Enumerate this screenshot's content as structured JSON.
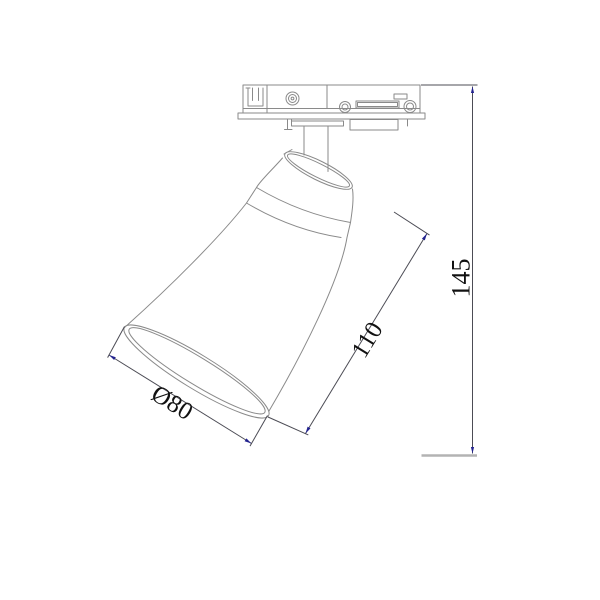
{
  "dimensions": {
    "diameter": {
      "label": "Ø80"
    },
    "length": {
      "label": "110"
    },
    "height": {
      "label": "145"
    }
  },
  "colors": {
    "background": "#ffffff",
    "outline": "#8a8a8a",
    "dimension": "#4c4c55",
    "arrow": "#23238f",
    "label_text": "#111111",
    "ground_line": "#b3b3b3"
  }
}
